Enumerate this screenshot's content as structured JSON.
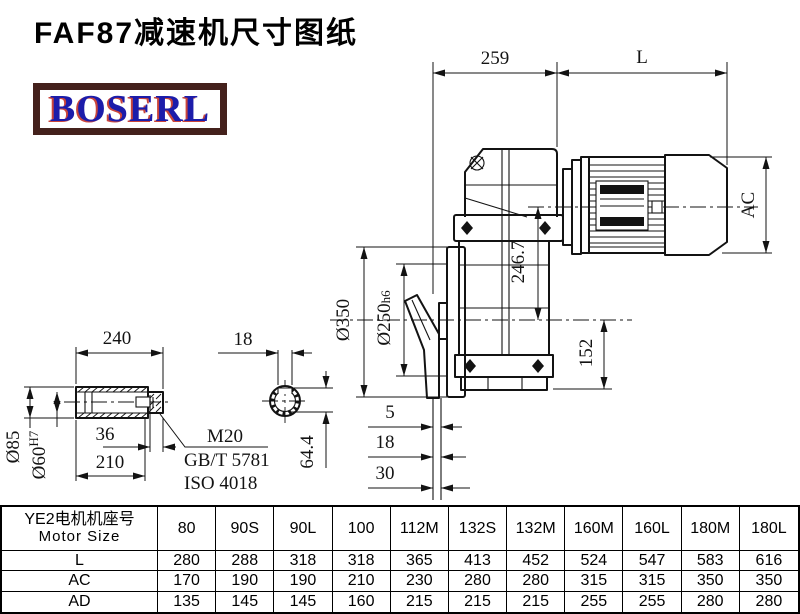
{
  "title": "FAF87减速机尺寸图纸",
  "logo": {
    "text": "BOSERL",
    "text_color": "#1c1caa",
    "accent_color": "#c33126",
    "border_color": "#44211c"
  },
  "drawing": {
    "main_view": {
      "gearbox_length": "259",
      "motor_length_var": "L",
      "motor_diameter_var": "AC",
      "flange_diameter": "Ø350",
      "spigot_diameter": "Ø250",
      "spigot_tolerance": "h6",
      "axis_distance": "246.7",
      "axis_to_base": "152",
      "face_offset_1": "5",
      "face_offset_2": "18",
      "face_offset_3": "30"
    },
    "shaft_view": {
      "sleeve_length": "240",
      "outer_diameter": "Ø85",
      "bore_diameter": "Ø60",
      "bore_tolerance": "H7",
      "end_step": "36",
      "sleeve_body": "210",
      "thread_callout": "M20",
      "standard_1": "GB/T 5781",
      "standard_2": "ISO 4018"
    },
    "section_view": {
      "keyway_width": "18",
      "keyway_depth": "64.4"
    }
  },
  "table": {
    "header": {
      "line1": "YE2电机机座号",
      "line2": "Motor Size"
    },
    "columns": [
      "80",
      "90S",
      "90L",
      "100",
      "112M",
      "132S",
      "132M",
      "160M",
      "160L",
      "180M",
      "180L"
    ],
    "rows": [
      {
        "label": "L",
        "values": [
          "280",
          "288",
          "318",
          "318",
          "365",
          "413",
          "452",
          "524",
          "547",
          "583",
          "616"
        ]
      },
      {
        "label": "AC",
        "values": [
          "170",
          "190",
          "190",
          "210",
          "230",
          "280",
          "280",
          "315",
          "315",
          "350",
          "350"
        ]
      },
      {
        "label": "AD",
        "values": [
          "135",
          "145",
          "145",
          "160",
          "215",
          "215",
          "215",
          "255",
          "255",
          "280",
          "280"
        ]
      }
    ]
  }
}
